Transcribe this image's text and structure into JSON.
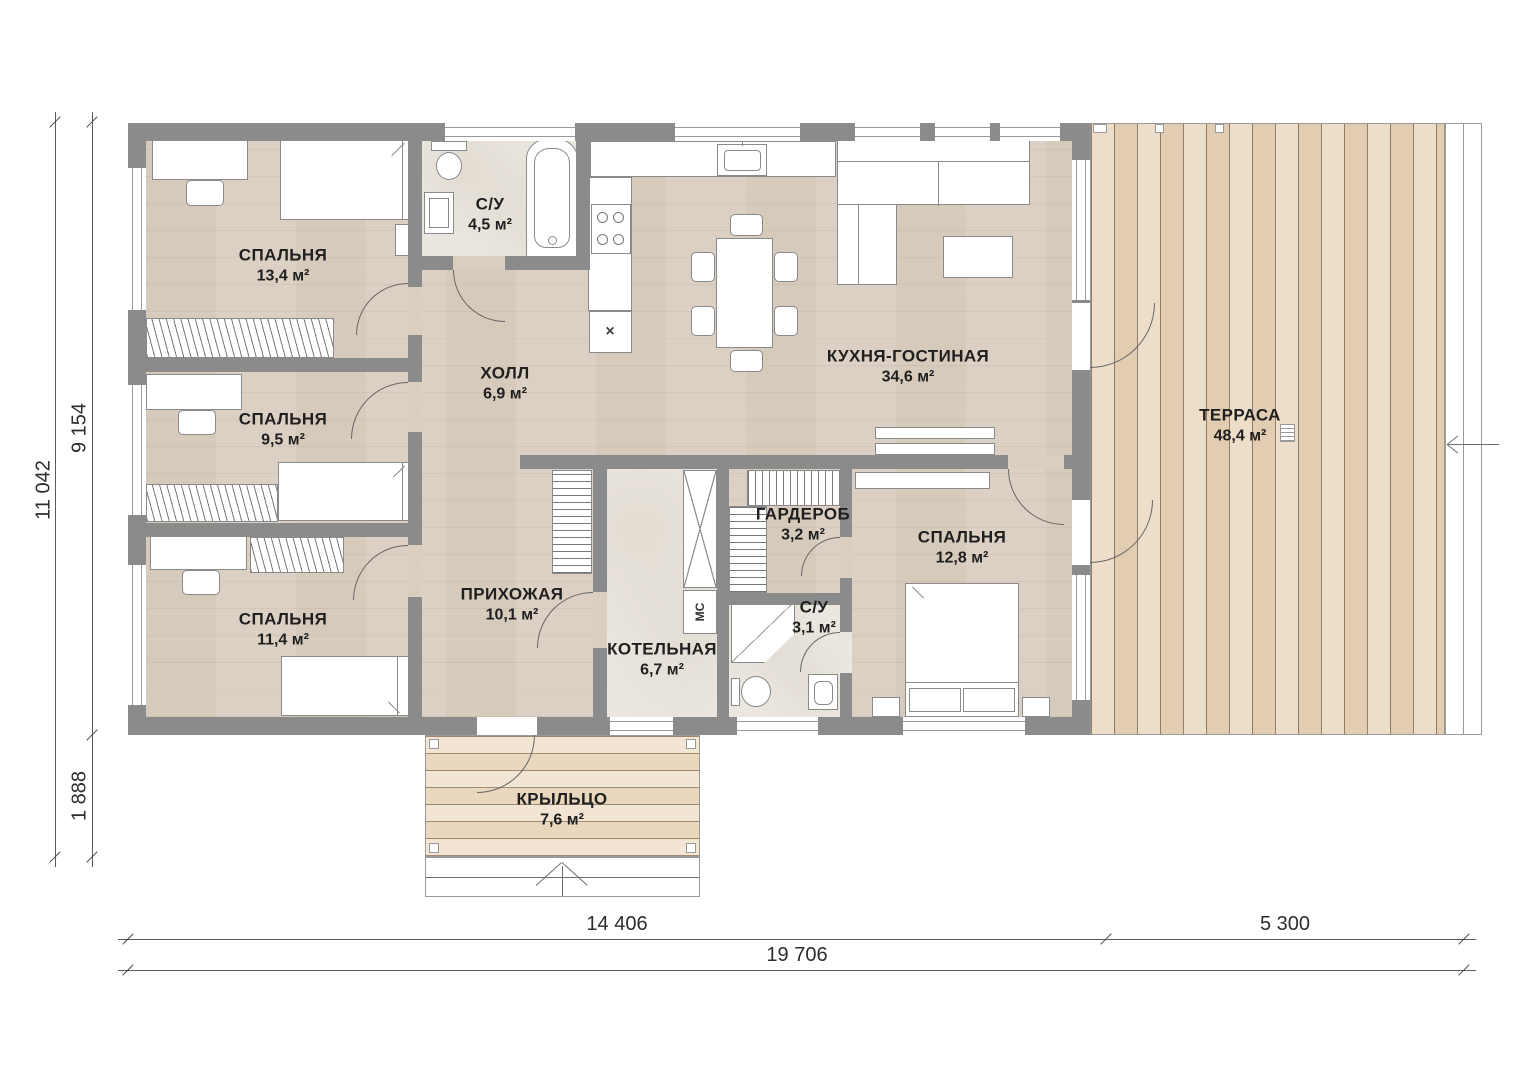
{
  "rooms": {
    "bedroom1": {
      "name": "СПАЛЬНЯ",
      "area": "13,4 м²"
    },
    "bathroom1": {
      "name": "С/У",
      "area": "4,5 м²"
    },
    "hall": {
      "name": "ХОЛЛ",
      "area": "6,9 м²"
    },
    "kitchen": {
      "name": "КУХНЯ-ГОСТИНАЯ",
      "area": "34,6 м²"
    },
    "terrace": {
      "name": "ТЕРРАСА",
      "area": "48,4 м²"
    },
    "bedroom2": {
      "name": "СПАЛЬНЯ",
      "area": "9,5 м²"
    },
    "bedroom3": {
      "name": "СПАЛЬНЯ",
      "area": "11,4 м²"
    },
    "entry": {
      "name": "ПРИХОЖАЯ",
      "area": "10,1 м²"
    },
    "boiler": {
      "name": "КОТЕЛЬНАЯ",
      "area": "6,7 м²"
    },
    "wardrobe": {
      "name": "ГАРДЕРОБ",
      "area": "3,2 м²"
    },
    "bathroom2": {
      "name": "С/У",
      "area": "3,1 м²"
    },
    "bedroom4": {
      "name": "СПАЛЬНЯ",
      "area": "12,8 м²"
    },
    "porch": {
      "name": "КРЫЛЬЦО",
      "area": "7,6 м²"
    }
  },
  "dimensions": {
    "left_total": "11 042",
    "left_main": "9 154",
    "left_porch": "1 888",
    "bottom_house": "14 406",
    "bottom_terrace": "5 300",
    "bottom_total": "19 706"
  },
  "labels": {
    "washing_machine": "МС",
    "appliance_mark": "×"
  },
  "palette": {
    "wall": "#8b8b8b",
    "floor_wood": "#d9cec0",
    "terrace_wood": "#e9d7bf",
    "porch_wood": "#f0e1cb",
    "tile": "#ebe7e0",
    "dimension_line": "#5a5a5a"
  }
}
